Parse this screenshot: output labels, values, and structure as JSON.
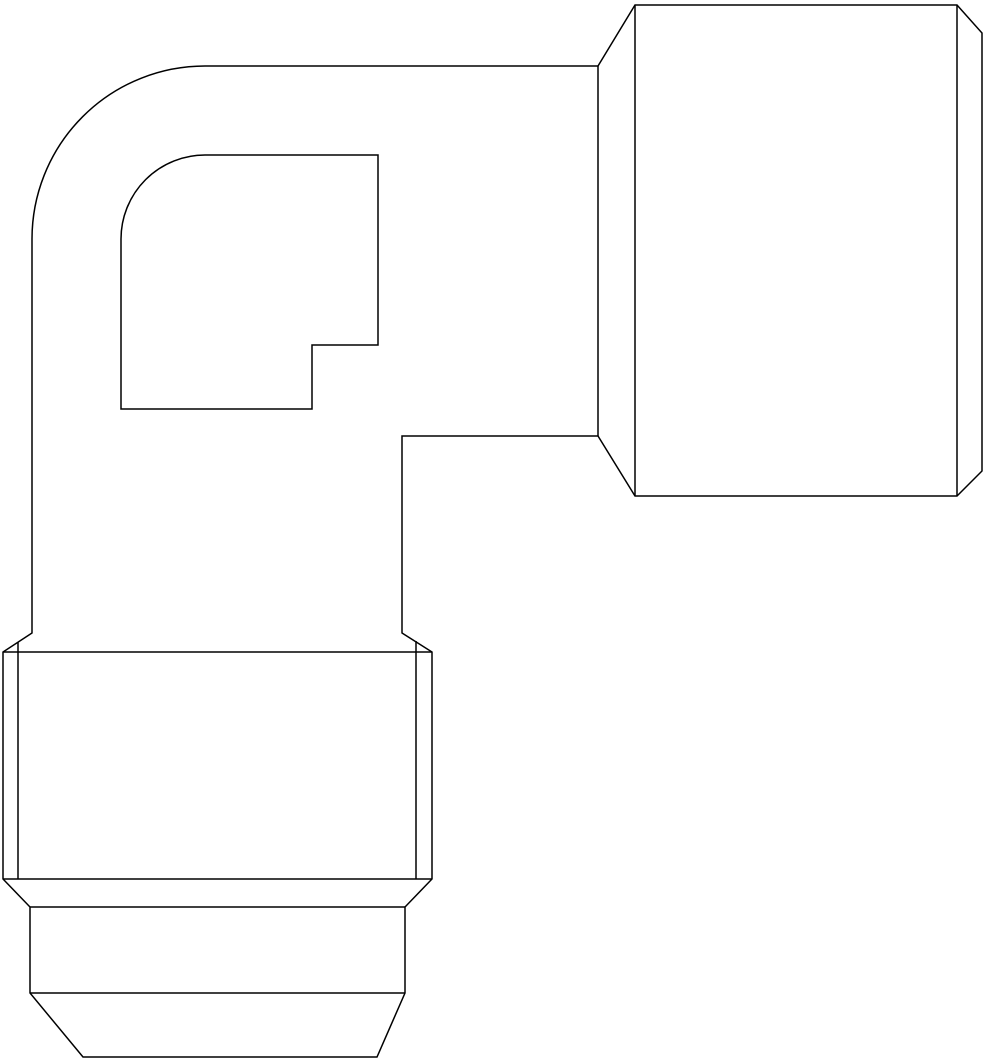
{
  "drawing": {
    "description": "Technical line drawing of a 90-degree flare elbow fitting, side view, with a horizontal nut end at upper right and a vertical nut end with tapered nose at bottom left",
    "canvas": {
      "width": 984,
      "height": 1064,
      "background": "#ffffff"
    },
    "stroke": {
      "color": "#000000",
      "width": 1.5
    },
    "paths": [
      {
        "name": "outer-silhouette",
        "d": "M 32 633 L 32 239 A 173 173 0 0 1 205 66 L 598 66 L 635 5 L 957 5 L 982 33 L 982 471 L 957 496 L 635 496 L 598 436 L 402 436 L 402 633 L 432 652 L 432 879 L 405 907 L 405 993 L 377 1057 L 83 1057 L 30 993 L 30 907 L 3 879 L 3 652 Z"
      },
      {
        "name": "inner-bore-profile",
        "d": "M 121 409 L 121 239 A 84 84 0 0 1 205 155 L 378 155 L 378 345 L 312 345 L 312 409 Z"
      },
      {
        "name": "right-nut-face-edge",
        "d": "M 635 5 L 635 496"
      },
      {
        "name": "right-nut-chamfer-base-edge",
        "d": "M 957 5 L 957 496"
      },
      {
        "name": "right-cone-face-edge",
        "d": "M 598 66 L 598 436"
      },
      {
        "name": "bottom-nut-chamfer-base-edge",
        "d": "M 3 652 L 432 652"
      },
      {
        "name": "bottom-nut-hex-lower-edge",
        "d": "M 3 879 L 432 879"
      },
      {
        "name": "bottom-nose-shoulder-edge",
        "d": "M 30 907 L 405 907"
      },
      {
        "name": "bottom-nose-taper-edge",
        "d": "M 30 993 L 405 993"
      },
      {
        "name": "bottom-hex-flat-boundary-left",
        "d": "M 18 642 L 18 879"
      },
      {
        "name": "bottom-hex-flat-boundary-right",
        "d": "M 416 641 L 416 879"
      }
    ]
  }
}
